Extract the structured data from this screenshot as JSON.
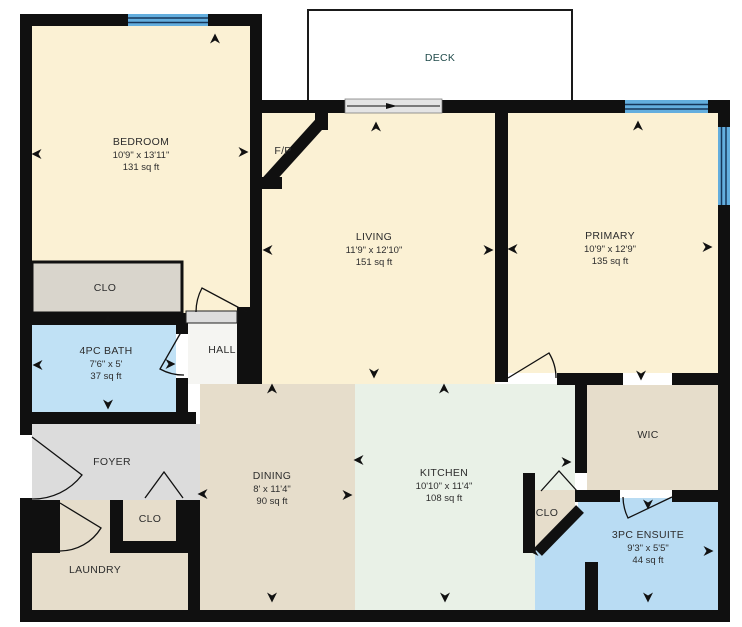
{
  "plan": {
    "type": "floor-plan",
    "rooms": {
      "deck": {
        "name": "DECK"
      },
      "bedroom": {
        "name": "BEDROOM",
        "dims": "10'9\" x 13'11\"",
        "area": "131 sq ft"
      },
      "fireplace": {
        "name": "F/P"
      },
      "living": {
        "name": "LIVING",
        "dims": "11'9\" x 12'10\"",
        "area": "151 sq ft"
      },
      "primary": {
        "name": "PRIMARY",
        "dims": "10'9\" x 12'9\"",
        "area": "135 sq ft"
      },
      "closet_bedroom": {
        "name": "CLO"
      },
      "bath": {
        "name": "4PC BATH",
        "dims": "7'6\" x 5'",
        "area": "37 sq ft"
      },
      "hall": {
        "name": "HALL"
      },
      "foyer": {
        "name": "FOYER"
      },
      "closet_foyer": {
        "name": "CLO"
      },
      "laundry": {
        "name": "LAUNDRY"
      },
      "dining": {
        "name": "DINING",
        "dims": "8' x 11'4\"",
        "area": "90 sq ft"
      },
      "kitchen": {
        "name": "KITCHEN",
        "dims": "10'10\" x 11'4\"",
        "area": "108 sq ft"
      },
      "wic": {
        "name": "WIC"
      },
      "closet_kitchen": {
        "name": "CLO"
      },
      "ensuite": {
        "name": "3PC ENSUITE",
        "dims": "9'3\" x 5'5\"",
        "area": "44 sq ft"
      }
    },
    "colors": {
      "wall": "#101010",
      "room_cream": "#fbf1d4",
      "room_tan": "#e6ddcb",
      "foyer_gray": "#dcdcdc",
      "closet_gray": "#d9d5cc",
      "room_blue": "#c0e1f5",
      "ensuite_blue": "#b9dcf3",
      "room_mint": "#e9f1e7",
      "hall_white": "#f5f5f2",
      "window_blue": "#63aede",
      "window_line": "#16365a",
      "slider_gray": "#e4e4e4",
      "deck_white": "#ffffff"
    }
  }
}
